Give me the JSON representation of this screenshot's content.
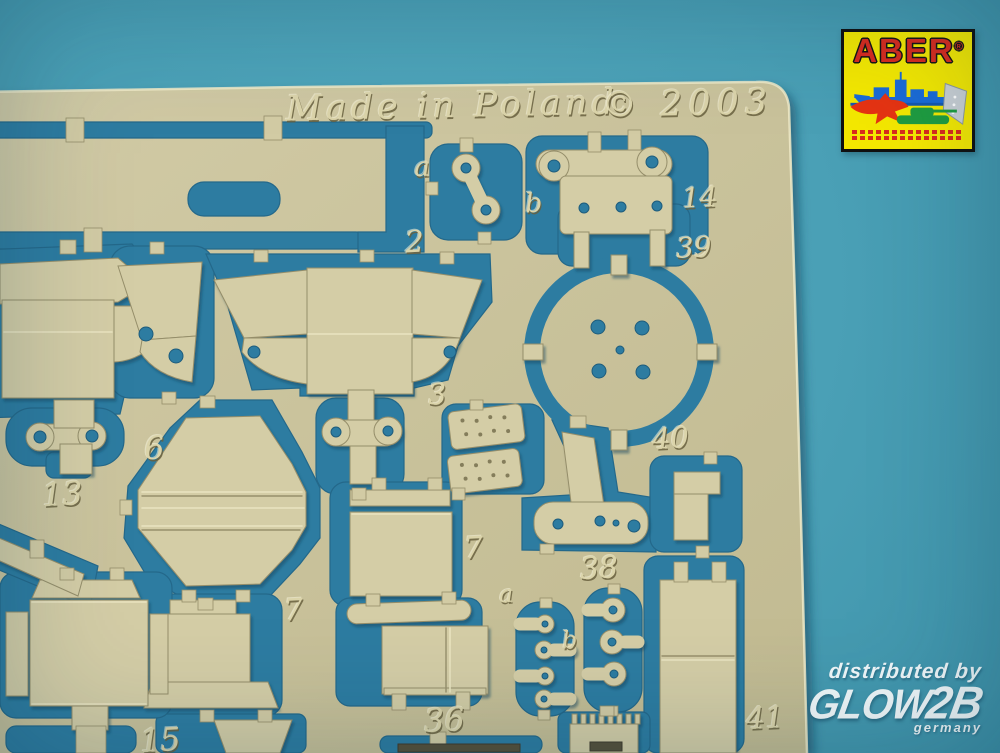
{
  "photo": {
    "background_color": "#4AA0B6",
    "cutout_color": "#2D7CA1",
    "sheet_color": "#CBC49D"
  },
  "sheet": {
    "etched_title": "Made in Poland",
    "etched_year": "© 2003",
    "part_labels": [
      {
        "text": "a",
        "x": 414,
        "y": 154,
        "size": 27
      },
      {
        "text": "b",
        "x": 525,
        "y": 190,
        "size": 27
      },
      {
        "text": "14",
        "x": 682,
        "y": 184,
        "size": 28
      },
      {
        "text": "2",
        "x": 405,
        "y": 228,
        "size": 30
      },
      {
        "text": "39",
        "x": 676,
        "y": 234,
        "size": 28
      },
      {
        "text": "13",
        "x": 42,
        "y": 478,
        "size": 32
      },
      {
        "text": "6",
        "x": 144,
        "y": 432,
        "size": 32
      },
      {
        "text": "3",
        "x": 428,
        "y": 380,
        "size": 29
      },
      {
        "text": "40",
        "x": 652,
        "y": 424,
        "size": 29
      },
      {
        "text": "7",
        "x": 464,
        "y": 534,
        "size": 30
      },
      {
        "text": "7",
        "x": 284,
        "y": 596,
        "size": 30
      },
      {
        "text": "38",
        "x": 580,
        "y": 554,
        "size": 30
      },
      {
        "text": "a",
        "x": 499,
        "y": 582,
        "size": 24
      },
      {
        "text": "b",
        "x": 562,
        "y": 628,
        "size": 24
      },
      {
        "text": "15",
        "x": 140,
        "y": 724,
        "size": 32
      },
      {
        "text": "36",
        "x": 424,
        "y": 704,
        "size": 32
      },
      {
        "text": "41",
        "x": 746,
        "y": 704,
        "size": 30
      }
    ]
  },
  "aber_logo": {
    "brand": "ABER",
    "registered": "®",
    "icon_names": [
      "battleship-icon",
      "jet-icon",
      "tank-icon",
      "ship-bow-icon"
    ],
    "brand_color": "#D92B1E",
    "box_color": "#F4E800"
  },
  "distributor": {
    "line": "distributed by",
    "brand_glow": "GLOW",
    "brand_2b": "2B",
    "country": "germany"
  }
}
